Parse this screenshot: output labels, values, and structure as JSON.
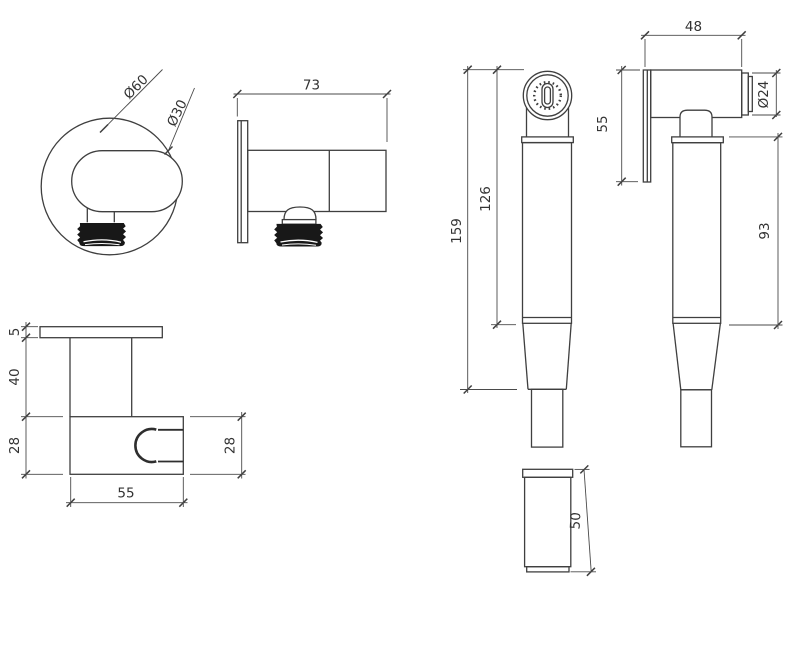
{
  "drawing_title": "Bidet spray handset with wall bracket - dimensioned technical drawing",
  "units": "mm",
  "colors": {
    "outline": "#3f3f3f",
    "dimension": "#4a4a4a",
    "text": "#333333",
    "thread_fill": "#181818",
    "background": "#ffffff"
  },
  "views": {
    "bracket_front": {
      "label_outer_dia": "Ø60",
      "label_inner_dia": "Ø30"
    },
    "bracket_side": {
      "label_width": "73"
    },
    "holder": {
      "label_plate_thickness": "5",
      "label_stem_height": "40",
      "label_body_height_left": "28",
      "label_body_height_right": "28",
      "label_body_width": "55"
    },
    "handset_front": {
      "label_total_length": "159",
      "label_body_length": "126",
      "label_backplate_height": "55"
    },
    "handset_side": {
      "label_head_length": "48",
      "label_cap_dia": "Ø24",
      "label_handle_length": "93"
    },
    "sleeve": {
      "label_height": "50"
    }
  }
}
